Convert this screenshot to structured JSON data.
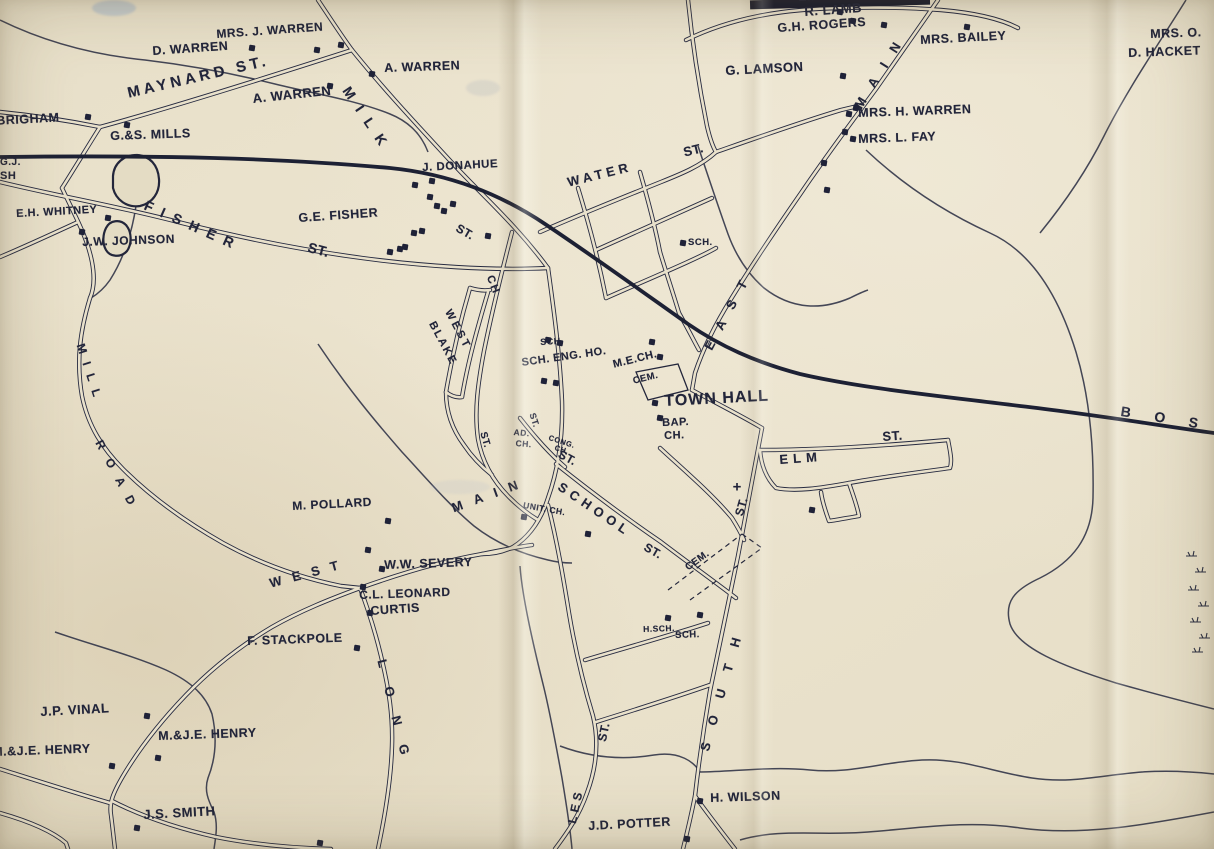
{
  "map": {
    "description": "vintage-town-street-map",
    "paper_color": "#e7dfc8",
    "ink_color": "#22253a",
    "railroad_destination_label": "B O S",
    "labels": [
      {
        "id": "mrs-j-warren",
        "text": "MRS. J. WARREN",
        "x": 216,
        "y": 28,
        "rot": -4,
        "size": 12
      },
      {
        "id": "d-warren",
        "text": "D. WARREN",
        "x": 152,
        "y": 45,
        "rot": -4,
        "size": 12.5
      },
      {
        "id": "a-warren-upper",
        "text": "A. WARREN",
        "x": 384,
        "y": 62,
        "rot": -2,
        "size": 12.5
      },
      {
        "id": "a-warren-lower",
        "text": "A. WARREN",
        "x": 252,
        "y": 92,
        "rot": -6,
        "size": 13
      },
      {
        "id": "maynard-st",
        "text": "MAYNARD ST.",
        "x": 126,
        "y": 86,
        "rot": -13,
        "size": 15,
        "ls": 4
      },
      {
        "id": "brigham",
        "text": ".BRIGHAM",
        "x": -8,
        "y": 115,
        "rot": -3,
        "size": 12.5
      },
      {
        "id": "gs-mills",
        "text": "G.&S. MILLS",
        "x": 110,
        "y": 130,
        "rot": -2,
        "size": 12.5
      },
      {
        "id": "gj-partial",
        "text": "G.J.",
        "x": 0,
        "y": 158,
        "rot": 0,
        "size": 10
      },
      {
        "id": "sh-partial",
        "text": "SH",
        "x": 0,
        "y": 171,
        "rot": 0,
        "size": 11
      },
      {
        "id": "eh-whitney",
        "text": "E.H. WHITNEY",
        "x": 16,
        "y": 209,
        "rot": -3,
        "size": 11
      },
      {
        "id": "jw-johnson",
        "text": "J.W. JOHNSON",
        "x": 82,
        "y": 236,
        "rot": -2,
        "size": 12
      },
      {
        "id": "fisher",
        "text": "FISHER",
        "x": 148,
        "y": 198,
        "rot": 24,
        "size": 14,
        "ls": 9
      },
      {
        "id": "fisher-st",
        "text": "ST.",
        "x": 310,
        "y": 240,
        "rot": 15,
        "size": 14
      },
      {
        "id": "ge-fisher",
        "text": "G.E. FISHER",
        "x": 298,
        "y": 212,
        "rot": -4,
        "size": 12.5
      },
      {
        "id": "j-donahue",
        "text": "J. DONAHUE",
        "x": 422,
        "y": 163,
        "rot": -3,
        "size": 11.5
      },
      {
        "id": "milk",
        "text": "MILK",
        "x": 352,
        "y": 84,
        "rot": 56,
        "size": 14,
        "ls": 11
      },
      {
        "id": "milk-st",
        "text": "ST.",
        "x": 460,
        "y": 222,
        "rot": 30,
        "size": 12
      },
      {
        "id": "water",
        "text": "WATER",
        "x": 566,
        "y": 176,
        "rot": -14,
        "size": 13,
        "ls": 4
      },
      {
        "id": "water-st",
        "text": "ST.",
        "x": 682,
        "y": 146,
        "rot": -14,
        "size": 13
      },
      {
        "id": "sch-water",
        "text": "SCH.",
        "x": 688,
        "y": 238,
        "rot": 0,
        "size": 9.5
      },
      {
        "id": "east",
        "text": "EAST",
        "x": 702,
        "y": 346,
        "rot": -62,
        "size": 13,
        "ls": 14
      },
      {
        "id": "main-upper",
        "text": "MAIN",
        "x": 852,
        "y": 104,
        "rot": -58,
        "size": 13,
        "ls": 14
      },
      {
        "id": "r-lamb",
        "text": "R. LAMB",
        "x": 804,
        "y": 5,
        "rot": -4,
        "size": 13
      },
      {
        "id": "gh-rogers",
        "text": "G.H. ROGERS",
        "x": 777,
        "y": 22,
        "rot": -4,
        "size": 12.5
      },
      {
        "id": "haskell-clipped",
        "text": "E.H. HASKELL",
        "x": 798,
        "y": -9,
        "rot": -3,
        "size": 12
      },
      {
        "id": "mrs-bailey",
        "text": "MRS. BAILEY",
        "x": 920,
        "y": 34,
        "rot": -3,
        "size": 12.5
      },
      {
        "id": "g-lamson",
        "text": "G. LAMSON",
        "x": 725,
        "y": 64,
        "rot": -3,
        "size": 13
      },
      {
        "id": "mrs-h-warren",
        "text": "MRS. H. WARREN",
        "x": 858,
        "y": 107,
        "rot": -2,
        "size": 12.5
      },
      {
        "id": "mrs-l-fay",
        "text": "MRS. L. FAY",
        "x": 858,
        "y": 133,
        "rot": -2,
        "size": 12.5
      },
      {
        "id": "mrs-o-clipped",
        "text": "MRS. O.",
        "x": 1150,
        "y": 28,
        "rot": -2,
        "size": 12.5
      },
      {
        "id": "d-hacke-clipped",
        "text": "D. HACKET",
        "x": 1128,
        "y": 47,
        "rot": -2,
        "size": 12.5
      },
      {
        "id": "ch-street",
        "text": "CH",
        "x": 494,
        "y": 274,
        "rot": 68,
        "size": 11,
        "ls": 2
      },
      {
        "id": "west-village",
        "text": "WEST",
        "x": 452,
        "y": 308,
        "rot": 62,
        "size": 11,
        "ls": 3
      },
      {
        "id": "blake",
        "text": "BLAKE",
        "x": 436,
        "y": 320,
        "rot": 62,
        "size": 11,
        "ls": 2
      },
      {
        "id": "st-village",
        "text": "ST.",
        "x": 487,
        "y": 431,
        "rot": 74,
        "size": 10
      },
      {
        "id": "sch-small",
        "text": "SCH.",
        "x": 540,
        "y": 338,
        "rot": -3,
        "size": 9
      },
      {
        "id": "sch-eng-ho",
        "text": "SCH. ENG. HO.",
        "x": 521,
        "y": 358,
        "rot": -8,
        "size": 11
      },
      {
        "id": "me-ch",
        "text": "M.E.CH.",
        "x": 612,
        "y": 360,
        "rot": -14,
        "size": 11
      },
      {
        "id": "cem-north",
        "text": "CEM.",
        "x": 632,
        "y": 377,
        "rot": -14,
        "size": 9.5
      },
      {
        "id": "town-hall",
        "text": "TOWN HALL",
        "x": 664,
        "y": 394,
        "rot": -3,
        "size": 16,
        "ls": 1
      },
      {
        "id": "bap",
        "text": "BAP.",
        "x": 662,
        "y": 418,
        "rot": -2,
        "size": 11
      },
      {
        "id": "bap-ch",
        "text": "CH.",
        "x": 664,
        "y": 431,
        "rot": -2,
        "size": 11
      },
      {
        "id": "ad",
        "text": "AD.",
        "x": 514,
        "y": 428,
        "rot": 5,
        "size": 8.5
      },
      {
        "id": "ad-ch",
        "text": "CH.",
        "x": 516,
        "y": 439,
        "rot": 5,
        "size": 8.5
      },
      {
        "id": "st-adams",
        "text": "ST.",
        "x": 536,
        "y": 412,
        "rot": 72,
        "size": 9
      },
      {
        "id": "cong",
        "text": "CONG.",
        "x": 550,
        "y": 434,
        "rot": 18,
        "size": 7.5
      },
      {
        "id": "cong-ch",
        "text": "CH.",
        "x": 556,
        "y": 444,
        "rot": 18,
        "size": 7.5
      },
      {
        "id": "st-center",
        "text": "ST.",
        "x": 562,
        "y": 448,
        "rot": 28,
        "size": 12
      },
      {
        "id": "unit-ch",
        "text": "UNIT. CH.",
        "x": 524,
        "y": 501,
        "rot": 10,
        "size": 8.5
      },
      {
        "id": "main-center",
        "text": "MAIN",
        "x": 450,
        "y": 502,
        "rot": -20,
        "size": 13,
        "ls": 12
      },
      {
        "id": "school",
        "text": "SCHOOL",
        "x": 563,
        "y": 480,
        "rot": 34,
        "size": 13,
        "ls": 5
      },
      {
        "id": "school-st",
        "text": "ST.",
        "x": 648,
        "y": 541,
        "rot": 30,
        "size": 12
      },
      {
        "id": "cem-south",
        "text": "CEM.",
        "x": 684,
        "y": 565,
        "rot": -36,
        "size": 10
      },
      {
        "id": "elm",
        "text": "ELM",
        "x": 779,
        "y": 453,
        "rot": -4,
        "size": 13,
        "ls": 5
      },
      {
        "id": "elm-st",
        "text": "ST.",
        "x": 882,
        "y": 430,
        "rot": -4,
        "size": 13
      },
      {
        "id": "south",
        "text": "SOUTH",
        "x": 698,
        "y": 749,
        "rot": -74,
        "size": 13,
        "ls": 18
      },
      {
        "id": "south-st",
        "text": "ST.",
        "x": 733,
        "y": 514,
        "rot": -74,
        "size": 12
      },
      {
        "id": "ruggles-st-part",
        "text": "ST.",
        "x": 596,
        "y": 740,
        "rot": -78,
        "size": 12
      },
      {
        "id": "ruggles-les-part",
        "text": "LES",
        "x": 566,
        "y": 822,
        "rot": -78,
        "size": 12,
        "ls": 4
      },
      {
        "id": "boston-rr",
        "text": "B O S",
        "x": 1122,
        "y": 404,
        "rot": 9,
        "size": 14,
        "ls": 10
      },
      {
        "id": "mill",
        "text": "MILL",
        "x": 86,
        "y": 342,
        "rot": 72,
        "size": 12,
        "ls": 9
      },
      {
        "id": "road",
        "text": "ROAD",
        "x": 104,
        "y": 438,
        "rot": 62,
        "size": 12,
        "ls": 12
      },
      {
        "id": "long",
        "text": "LONG",
        "x": 388,
        "y": 658,
        "rot": 76,
        "size": 13,
        "ls": 20
      },
      {
        "id": "west-road",
        "text": "WEST",
        "x": 268,
        "y": 577,
        "rot": -15,
        "size": 13,
        "ls": 11
      },
      {
        "id": "m-pollard",
        "text": "M. POLLARD",
        "x": 292,
        "y": 500,
        "rot": -3,
        "size": 12
      },
      {
        "id": "ww-severy",
        "text": "W.W. SEVERY",
        "x": 384,
        "y": 559,
        "rot": -2,
        "size": 12.5
      },
      {
        "id": "cl-leonard",
        "text": "C.L. LEONARD",
        "x": 359,
        "y": 589,
        "rot": -2,
        "size": 12
      },
      {
        "id": "curtis",
        "text": "CURTIS",
        "x": 370,
        "y": 605,
        "rot": -4,
        "size": 12.5
      },
      {
        "id": "f-stackpole",
        "text": "F. STACKPOLE",
        "x": 247,
        "y": 635,
        "rot": -2,
        "size": 12.5
      },
      {
        "id": "jp-vinal",
        "text": "J.P. VINAL",
        "x": 40,
        "y": 705,
        "rot": -3,
        "size": 13
      },
      {
        "id": "mje-henry-west",
        "text": "M.&J.E. HENRY",
        "x": -8,
        "y": 746,
        "rot": -2,
        "size": 12.5
      },
      {
        "id": "mje-henry",
        "text": "M.&J.E. HENRY",
        "x": 158,
        "y": 730,
        "rot": -2,
        "size": 12.5
      },
      {
        "id": "js-smith",
        "text": "J.S. SMITH",
        "x": 143,
        "y": 808,
        "rot": -3,
        "size": 13
      },
      {
        "id": "h-wilson",
        "text": "H. WILSON",
        "x": 710,
        "y": 792,
        "rot": -2,
        "size": 12.5
      },
      {
        "id": "jd-potter",
        "text": "J.D. POTTER",
        "x": 588,
        "y": 820,
        "rot": -3,
        "size": 12.5
      },
      {
        "id": "h-sch",
        "text": "H.SCH.",
        "x": 643,
        "y": 625,
        "rot": -2,
        "size": 8.5
      },
      {
        "id": "sch-south",
        "text": "SCH.",
        "x": 675,
        "y": 631,
        "rot": -2,
        "size": 9.5
      }
    ],
    "houses": [
      [
        252,
        48
      ],
      [
        317,
        50
      ],
      [
        341,
        45
      ],
      [
        372,
        74
      ],
      [
        330,
        86
      ],
      [
        88,
        117
      ],
      [
        127,
        125
      ],
      [
        108,
        218
      ],
      [
        82,
        232
      ],
      [
        415,
        185
      ],
      [
        432,
        181
      ],
      [
        430,
        197
      ],
      [
        437,
        206
      ],
      [
        444,
        211
      ],
      [
        453,
        204
      ],
      [
        422,
        231
      ],
      [
        414,
        233
      ],
      [
        400,
        249
      ],
      [
        390,
        252
      ],
      [
        405,
        247
      ],
      [
        488,
        236
      ],
      [
        840,
        12
      ],
      [
        853,
        21
      ],
      [
        884,
        25
      ],
      [
        967,
        27
      ],
      [
        843,
        76
      ],
      [
        856,
        108
      ],
      [
        849,
        114
      ],
      [
        845,
        132
      ],
      [
        853,
        139
      ],
      [
        824,
        163
      ],
      [
        827,
        190
      ],
      [
        683,
        243
      ],
      [
        548,
        340
      ],
      [
        560,
        343
      ],
      [
        544,
        381
      ],
      [
        556,
        383
      ],
      [
        652,
        342
      ],
      [
        660,
        357
      ],
      [
        655,
        403
      ],
      [
        660,
        418
      ],
      [
        812,
        510
      ],
      [
        524,
        517
      ],
      [
        588,
        534
      ],
      [
        668,
        618
      ],
      [
        700,
        615
      ],
      [
        382,
        569
      ],
      [
        363,
        587
      ],
      [
        370,
        613
      ],
      [
        357,
        648
      ],
      [
        388,
        521
      ],
      [
        368,
        550
      ],
      [
        147,
        716
      ],
      [
        158,
        758
      ],
      [
        112,
        766
      ],
      [
        137,
        828
      ],
      [
        320,
        843
      ],
      [
        700,
        801
      ],
      [
        687,
        839
      ]
    ],
    "church_cross": {
      "x": 737,
      "y": 487,
      "glyph": "+"
    }
  }
}
